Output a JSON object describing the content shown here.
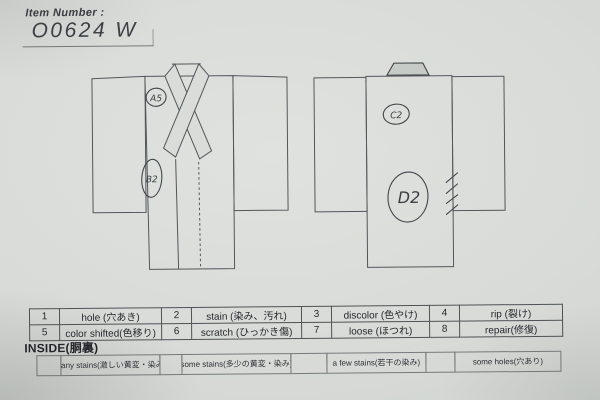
{
  "header": {
    "label": "Item Number :",
    "value": "O0624  W"
  },
  "diagram": {
    "front": {
      "annotations": [
        {
          "code": "A5"
        },
        {
          "code": "B2"
        }
      ]
    },
    "back": {
      "annotations": [
        {
          "code": "C2"
        },
        {
          "code": "D2"
        }
      ]
    }
  },
  "codes": {
    "items": [
      {
        "num": "1",
        "label": "hole (穴あき)"
      },
      {
        "num": "2",
        "label": "stain (染み、汚れ)"
      },
      {
        "num": "3",
        "label": "discolor (色やけ)"
      },
      {
        "num": "4",
        "label": "rip (裂け)"
      },
      {
        "num": "5",
        "label": "color shifted(色移り)"
      },
      {
        "num": "6",
        "label": "scratch (ひっかき傷)"
      },
      {
        "num": "7",
        "label": "loose (ほつれ)"
      },
      {
        "num": "8",
        "label": "repair(修復)"
      }
    ]
  },
  "inside": {
    "label": "INSIDE(胴裏)",
    "options": [
      {
        "label": "many stains(激しい黄変・染み)"
      },
      {
        "label": "some stains(多少の黄変・染み)"
      },
      {
        "label": "a few stains(若干の染み)"
      },
      {
        "label": "some holes(穴あり)"
      }
    ]
  },
  "colors": {
    "paper": "#d8dbd7",
    "printed_line": "#52575b",
    "ink_text": "#24282c",
    "pen": "#3a3f44"
  }
}
